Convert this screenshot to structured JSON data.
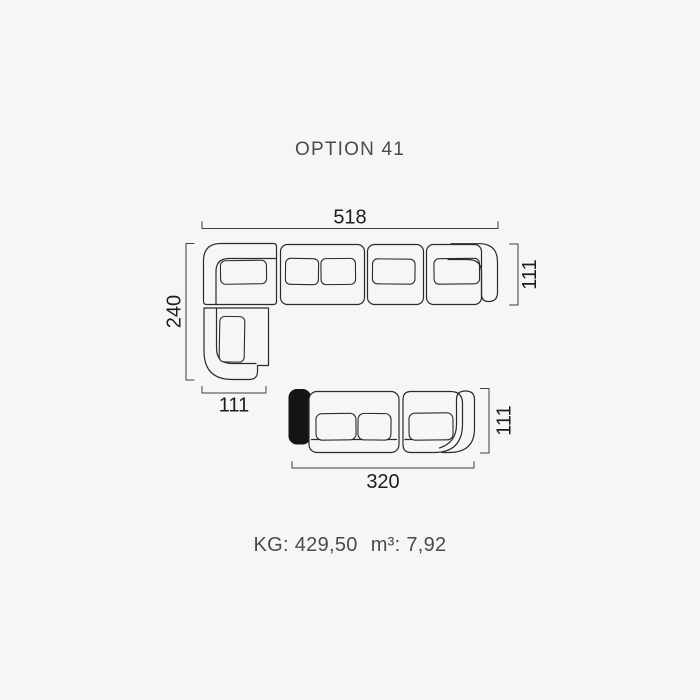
{
  "title": "OPTION 41",
  "colors": {
    "background": "#f6f6f6",
    "outline": "#2b2b2b",
    "dimension_line": "#3f3f3f",
    "dimension_text": "#1d1d1d",
    "label_text": "#4b4b4b",
    "black_module": "#141414"
  },
  "diagram": {
    "l_sofa": {
      "total_width": "518",
      "seat_depth": "111",
      "chaise_length": "240",
      "chaise_width": "111"
    },
    "small_sofa": {
      "total_width": "320",
      "seat_depth": "111"
    }
  },
  "footer": {
    "weight": "KG: 429,50",
    "volume": "m³: 7,92"
  }
}
